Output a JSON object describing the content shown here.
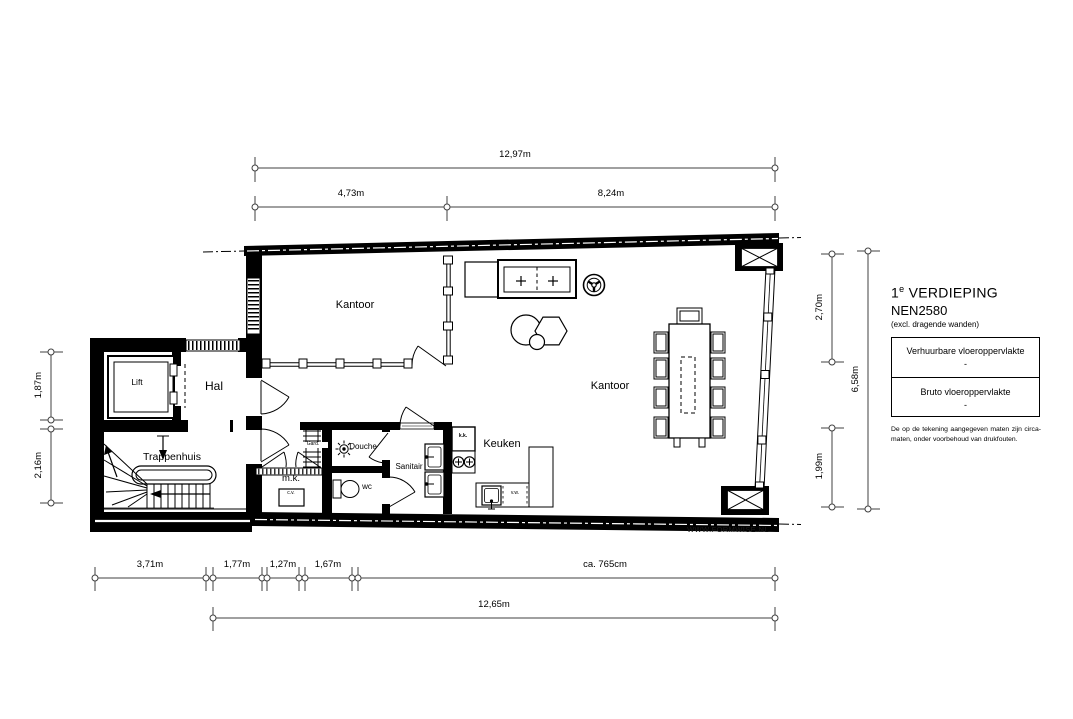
{
  "title_block": {
    "floor_number": "1",
    "floor_suffix": "e",
    "floor_label": "VERDIEPING",
    "standard": "NEN2580",
    "standard_note": "(excl. dragende wanden)",
    "area_table": {
      "row1_label": "Verhuurbare vloeroppervlakte",
      "row1_value": "-",
      "row2_label": "Bruto vloeroppervlakte",
      "row2_value": "-"
    },
    "disclaimer": "De op de tekening aangegeven maten zijn circa-maten, onder voorbehoud van drukfouten."
  },
  "watermark": "WWW.FORMWISE.NL",
  "rooms": {
    "kantoor_front": "Kantoor",
    "kantoor_main": "Kantoor",
    "hal": "Hal",
    "lift": "Lift",
    "trappenhuis": "Trappenhuis",
    "douche": "Douche",
    "sanitair": "Sanitair",
    "keuken": "Keuken",
    "mk": "m.k.",
    "wc": "wc",
    "gard": "Gard.",
    "kk": "k.k.",
    "cv": "c.v.",
    "vw": "v.w."
  },
  "dimensions": {
    "top_total": "12,97m",
    "top_left": "4,73m",
    "top_right": "8,24m",
    "left_upper": "1,87m",
    "left_lower": "2,16m",
    "right_upper": "2,70m",
    "right_lower": "1,99m",
    "right_total": "6,58m",
    "bottom_1": "3,71m",
    "bottom_2": "1,77m",
    "bottom_3": "1,27m",
    "bottom_4": "1,67m",
    "bottom_5": "ca. 765cm",
    "bottom_total": "12,65m"
  },
  "colors": {
    "wall": "#000000",
    "dim_line": "#404040"
  }
}
